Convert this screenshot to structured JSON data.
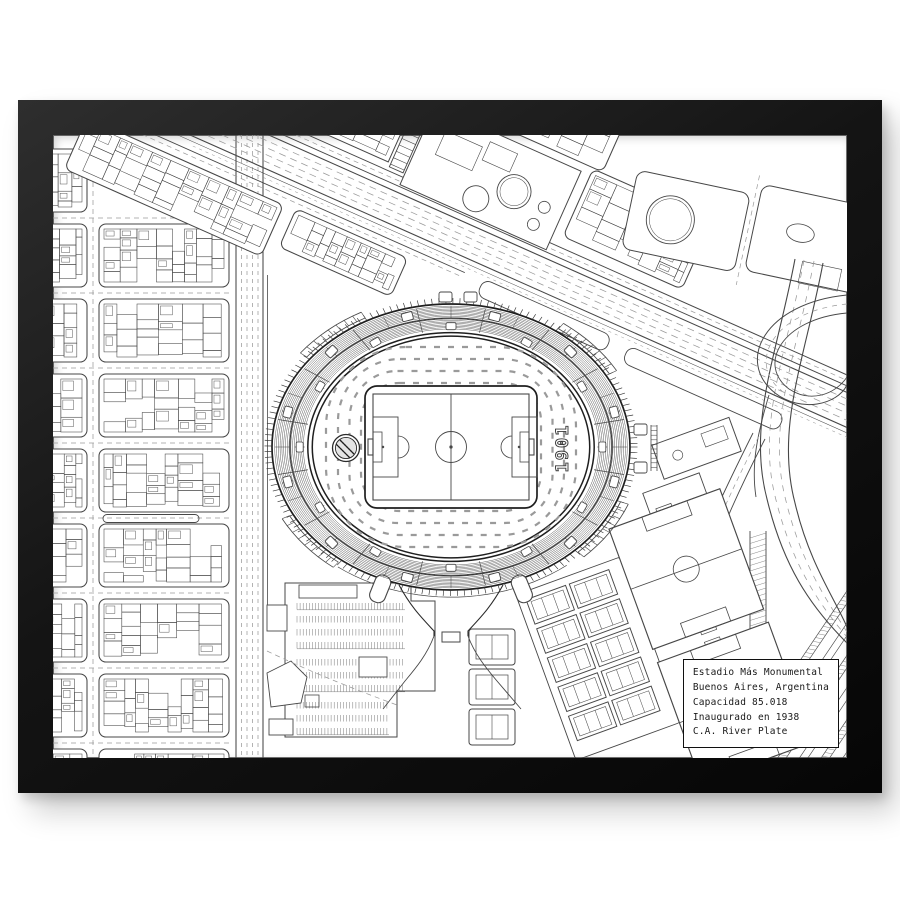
{
  "artwork": {
    "info_box": {
      "lines": [
        "Estadio Más Monumental",
        "Buenos Aires, Argentina",
        "Capacidad 85.018",
        "Inaugurado en 1938",
        "C.A. River Plate"
      ]
    },
    "stadium": {
      "name": "Estadio Más Monumental",
      "founded_year_label": "1901",
      "crest_icon": "river-plate-crest-icon"
    },
    "colors": {
      "wall": "#ffffff",
      "frame": "#141414",
      "paper": "#ffffff",
      "line": "#474747",
      "line_heavy": "#1f1f1f",
      "line_light": "#9a9a9a",
      "ink": "#1a1a1a"
    }
  }
}
